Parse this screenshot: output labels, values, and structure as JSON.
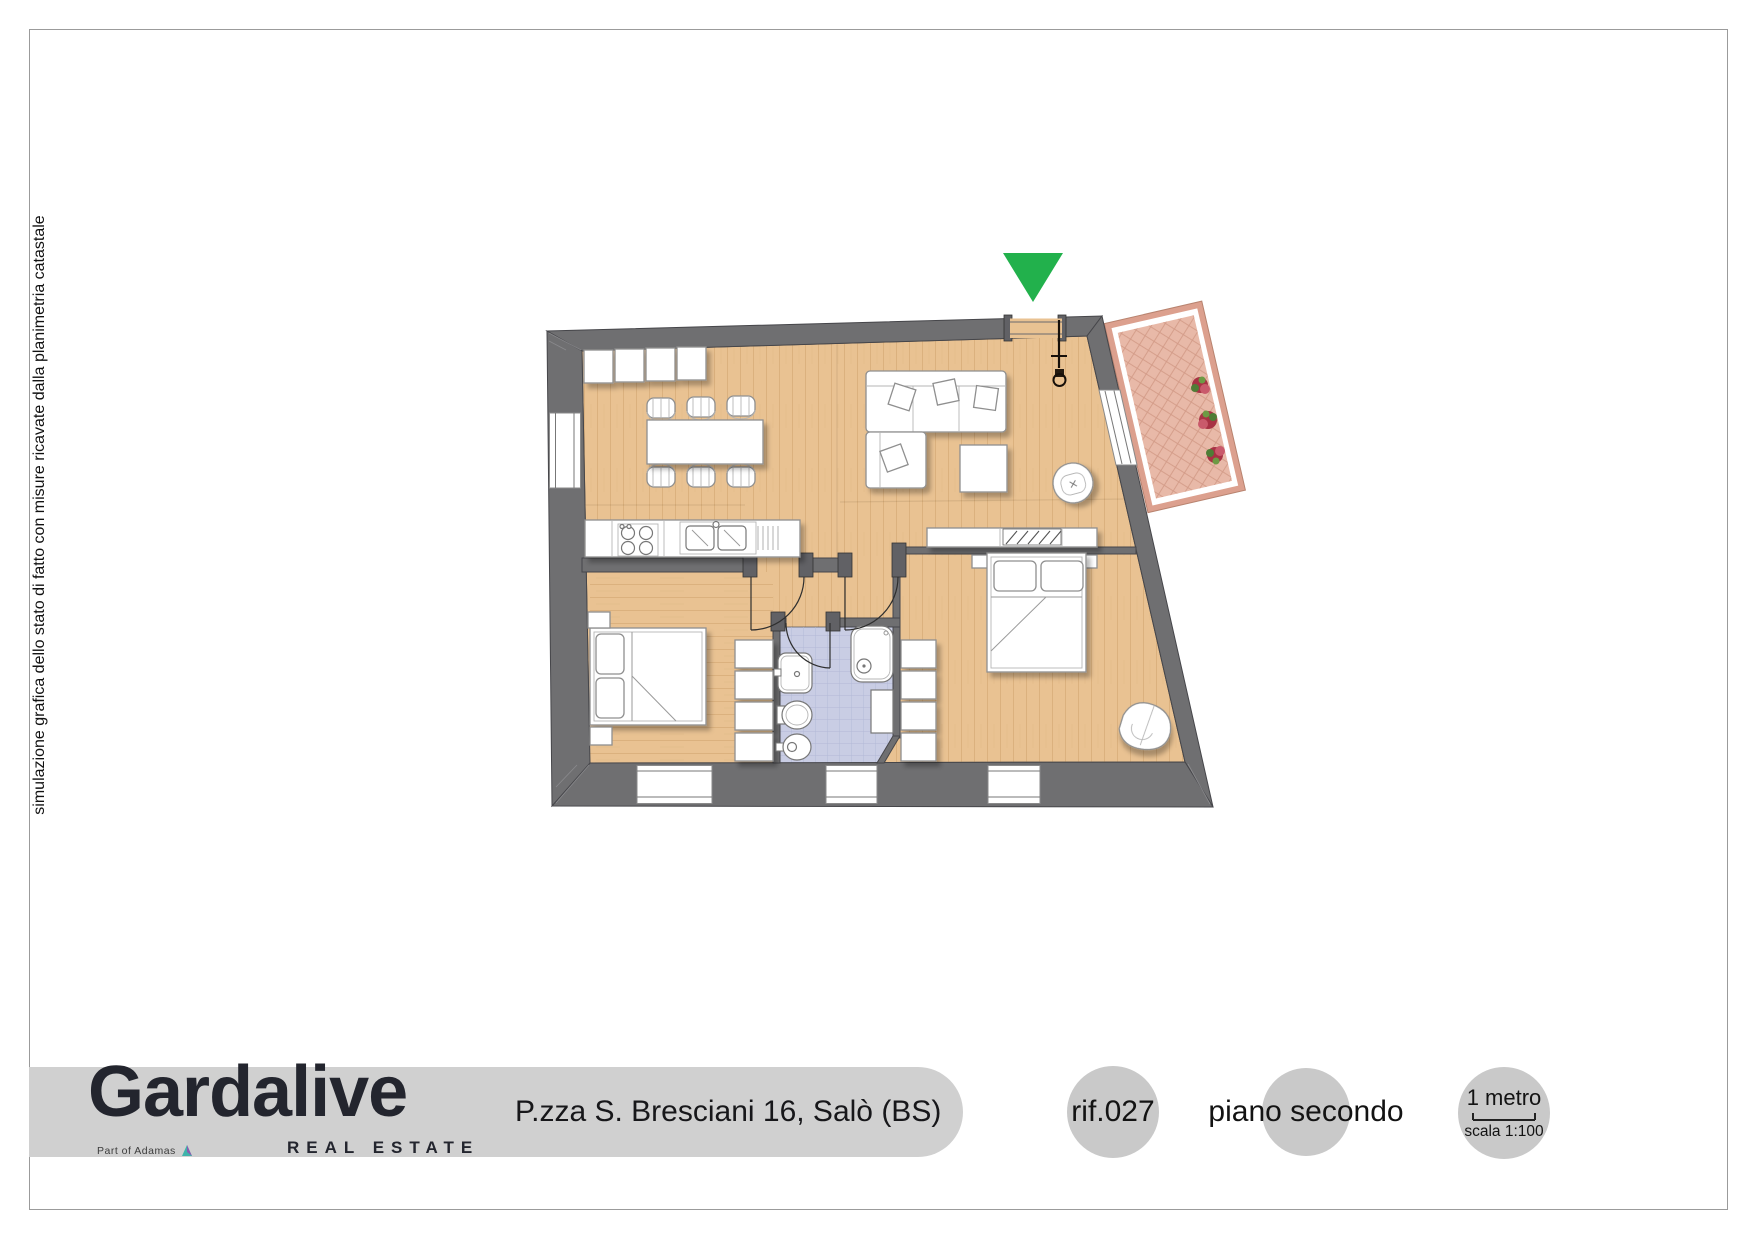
{
  "disclaimer": "simulazione grafica dello stato di fatto con misure ricavate dalla planimetria catastale",
  "footer": {
    "brand_name": "Gardalive",
    "brand_tagline": "REAL ESTATE",
    "brand_partner": "Part of Adamas",
    "address": "P.zza S. Bresciani 16, Salò (BS)",
    "reference": "rif.027",
    "floor_label": "piano secondo",
    "scale_length_label": "1 metro",
    "scale_ratio_label": "scala 1:100"
  },
  "theme": {
    "wall": "#6f6f71",
    "floor": "#e9c292",
    "floor_line": "#b98a4e",
    "bath_floor": "#c9cde4",
    "bath_line": "#b2b8d6",
    "balcony_floor": "#e8b9a8",
    "balcony_border": "#dca08e",
    "marker": "#22b14c",
    "band": "#d0d0d0",
    "circle": "#c9c9c9",
    "ink": "#23252e",
    "furniture_stroke": "#8f8f8f",
    "page_border": "#9b9b9b"
  }
}
